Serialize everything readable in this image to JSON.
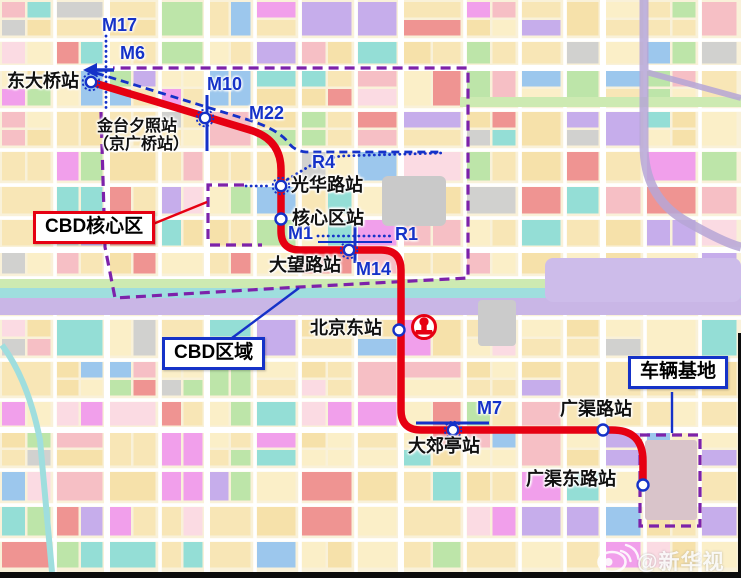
{
  "colors": {
    "line_red": "#e60012",
    "metro_blue": "#1532c8",
    "boundary_purple": "#7d22aa",
    "map_base": "#f9f1d9",
    "road_white": "#ffffff",
    "water_teal": "#9fdede",
    "green_band": "#cdeab2",
    "lavender_band": "#c9b6e6"
  },
  "stations": [
    {
      "name": "东大桥站",
      "interchange": true
    },
    {
      "name": "金台夕照站",
      "alt": "（京广桥站）",
      "interchange": true
    },
    {
      "name": "光华路站",
      "interchange": true
    },
    {
      "name": "核心区站",
      "interchange": false
    },
    {
      "name": "大望路站",
      "interchange": true
    },
    {
      "name": "北京东站",
      "interchange": false,
      "railway_hub": true
    },
    {
      "name": "大郊亭站",
      "interchange": true
    },
    {
      "name": "广渠路站",
      "interchange": false
    },
    {
      "name": "广渠东路站",
      "interchange": false
    }
  ],
  "line_labels": [
    {
      "id": "M17"
    },
    {
      "id": "M6"
    },
    {
      "id": "M10"
    },
    {
      "id": "M22"
    },
    {
      "id": "R4"
    },
    {
      "id": "M1"
    },
    {
      "id": "R1"
    },
    {
      "id": "M14"
    },
    {
      "id": "M7"
    }
  ],
  "callouts": [
    {
      "label": "CBD核心区",
      "border": "red"
    },
    {
      "label": "CBD区域",
      "border": "blue"
    },
    {
      "label": "车辆基地",
      "border": "blue"
    }
  ],
  "watermark": {
    "handle": "@新华视点",
    "logo": "weibo-icon"
  },
  "icons": [
    {
      "name": "railway-station-icon",
      "meaning": "China Railway emblem at 北京东站"
    },
    {
      "name": "m6-arrow-icon",
      "meaning": "west continuation arrow of line M6"
    }
  ],
  "palette": [
    "#f8e5b4",
    "#fbeec7",
    "#f6dfa8",
    "#f6bcc4",
    "#ee8e8e",
    "#8edcd6",
    "#b9e4a6",
    "#f09aec",
    "#c3a9ec",
    "#97c4ee",
    "#fbd9e4",
    "#cfcfcf"
  ]
}
